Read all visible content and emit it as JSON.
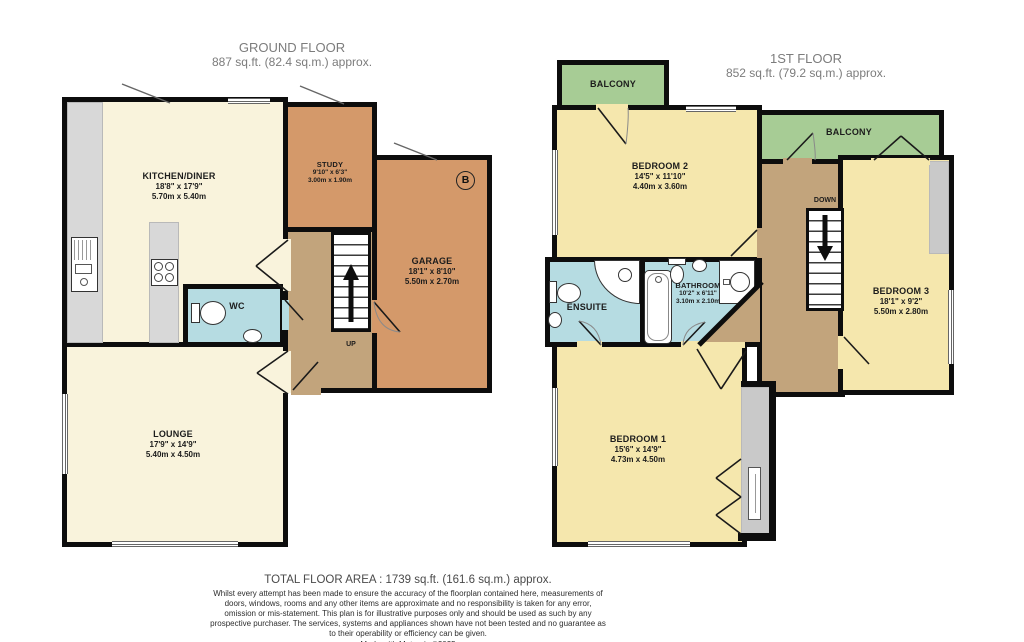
{
  "colors": {
    "wall": "#0d0d0d",
    "kitchen_lounge_cream": "#f9f3dc",
    "bedroom_yellow": "#f5e7ad",
    "study_garage_tan": "#d4996a",
    "hallway_landing_tan": "#c2a47c",
    "bathroom_blue": "#b6dce2",
    "balcony_green": "#a7cc95",
    "counter_gray": "#d8d8d8"
  },
  "ground_floor": {
    "title": "GROUND FLOOR",
    "area": "887 sq.ft. (82.4 sq.m.) approx.",
    "rooms": {
      "kitchen": {
        "name": "KITCHEN/DINER",
        "imperial": "18'8\" x 17'9\"",
        "metric": "5.70m x 5.40m"
      },
      "study": {
        "name": "STUDY",
        "imperial": "9'10\" x 6'3\"",
        "metric": "3.00m x 1.90m"
      },
      "garage": {
        "name": "GARAGE",
        "imperial": "18'1\" x 8'10\"",
        "metric": "5.50m x 2.70m"
      },
      "lounge": {
        "name": "LOUNGE",
        "imperial": "17'9\" x 14'9\"",
        "metric": "5.40m x 4.50m"
      },
      "wc": {
        "name": "WC"
      }
    },
    "stairs_label": "UP",
    "boiler_label": "B"
  },
  "first_floor": {
    "title": "1ST FLOOR",
    "area": "852 sq.ft. (79.2 sq.m.) approx.",
    "rooms": {
      "balcony_left": {
        "name": "BALCONY"
      },
      "balcony_right": {
        "name": "BALCONY"
      },
      "bedroom1": {
        "name": "BEDROOM 1",
        "imperial": "15'6\" x 14'9\"",
        "metric": "4.73m x 4.50m"
      },
      "bedroom2": {
        "name": "BEDROOM 2",
        "imperial": "14'5\" x 11'10\"",
        "metric": "4.40m x 3.60m"
      },
      "bedroom3": {
        "name": "BEDROOM 3",
        "imperial": "18'1\" x 9'2\"",
        "metric": "5.50m x 2.80m"
      },
      "ensuite": {
        "name": "ENSUITE"
      },
      "bathroom": {
        "name": "BATHROOM",
        "imperial": "10'2\" x 6'11\"",
        "metric": "3.10m x 2.10m"
      }
    },
    "stairs_label": "DOWN"
  },
  "footer": {
    "total_area": "TOTAL FLOOR AREA : 1739 sq.ft. (161.6 sq.m.) approx.",
    "disclaimer": "Whilst every attempt has been made to ensure the accuracy of the floorplan contained here, measurements of doors, windows, rooms and any other items are approximate and no responsibility is taken for any error, omission or mis-statement. This plan is for illustrative purposes only and should be used as such by any prospective purchaser. The services, systems and appliances shown have not been tested and no guarantee as to their operability or efficiency can be given.",
    "credit": "Made with Metropix ©2025"
  }
}
